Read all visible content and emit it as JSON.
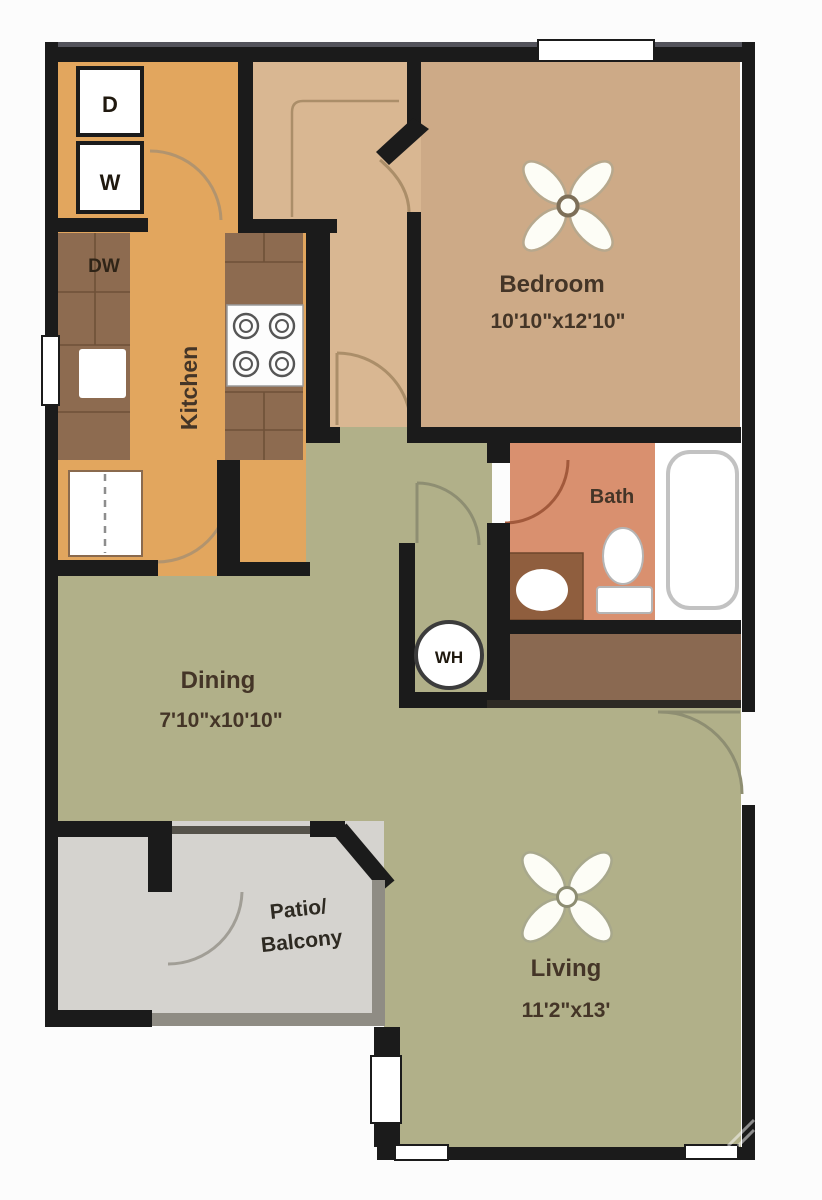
{
  "title": "One Bedroom Apartment Floor Plan",
  "rooms": {
    "bedroom": {
      "label": "Bedroom",
      "dims": "10'10\"x12'10\""
    },
    "bath": {
      "label": "Bath"
    },
    "kitchen": {
      "label": "Kitchen"
    },
    "dining": {
      "label": "Dining",
      "dims": "7'10\"x10'10\""
    },
    "living": {
      "label": "Living",
      "dims": "11'2\"x13'"
    },
    "patio": {
      "label_line1": "Patio/",
      "label_line2": "Balcony"
    }
  },
  "fixtures": {
    "dryer": "D",
    "washer": "W",
    "dishwasher": "DW",
    "water_heater": "WH"
  },
  "colors": {
    "wall": "#1b1b1b",
    "bedroom": "#cdaa87",
    "entry": "#d9b792",
    "kitchen": "#e2a65e",
    "counter": "#8d6b50",
    "bath": "#d9906f",
    "vanity": "#8f5e3e",
    "closet_brown": "#8a6951",
    "green": "#b1b089",
    "patio": "#d5d3cf",
    "rail": "#8f8c84",
    "white": "#ffffff"
  }
}
